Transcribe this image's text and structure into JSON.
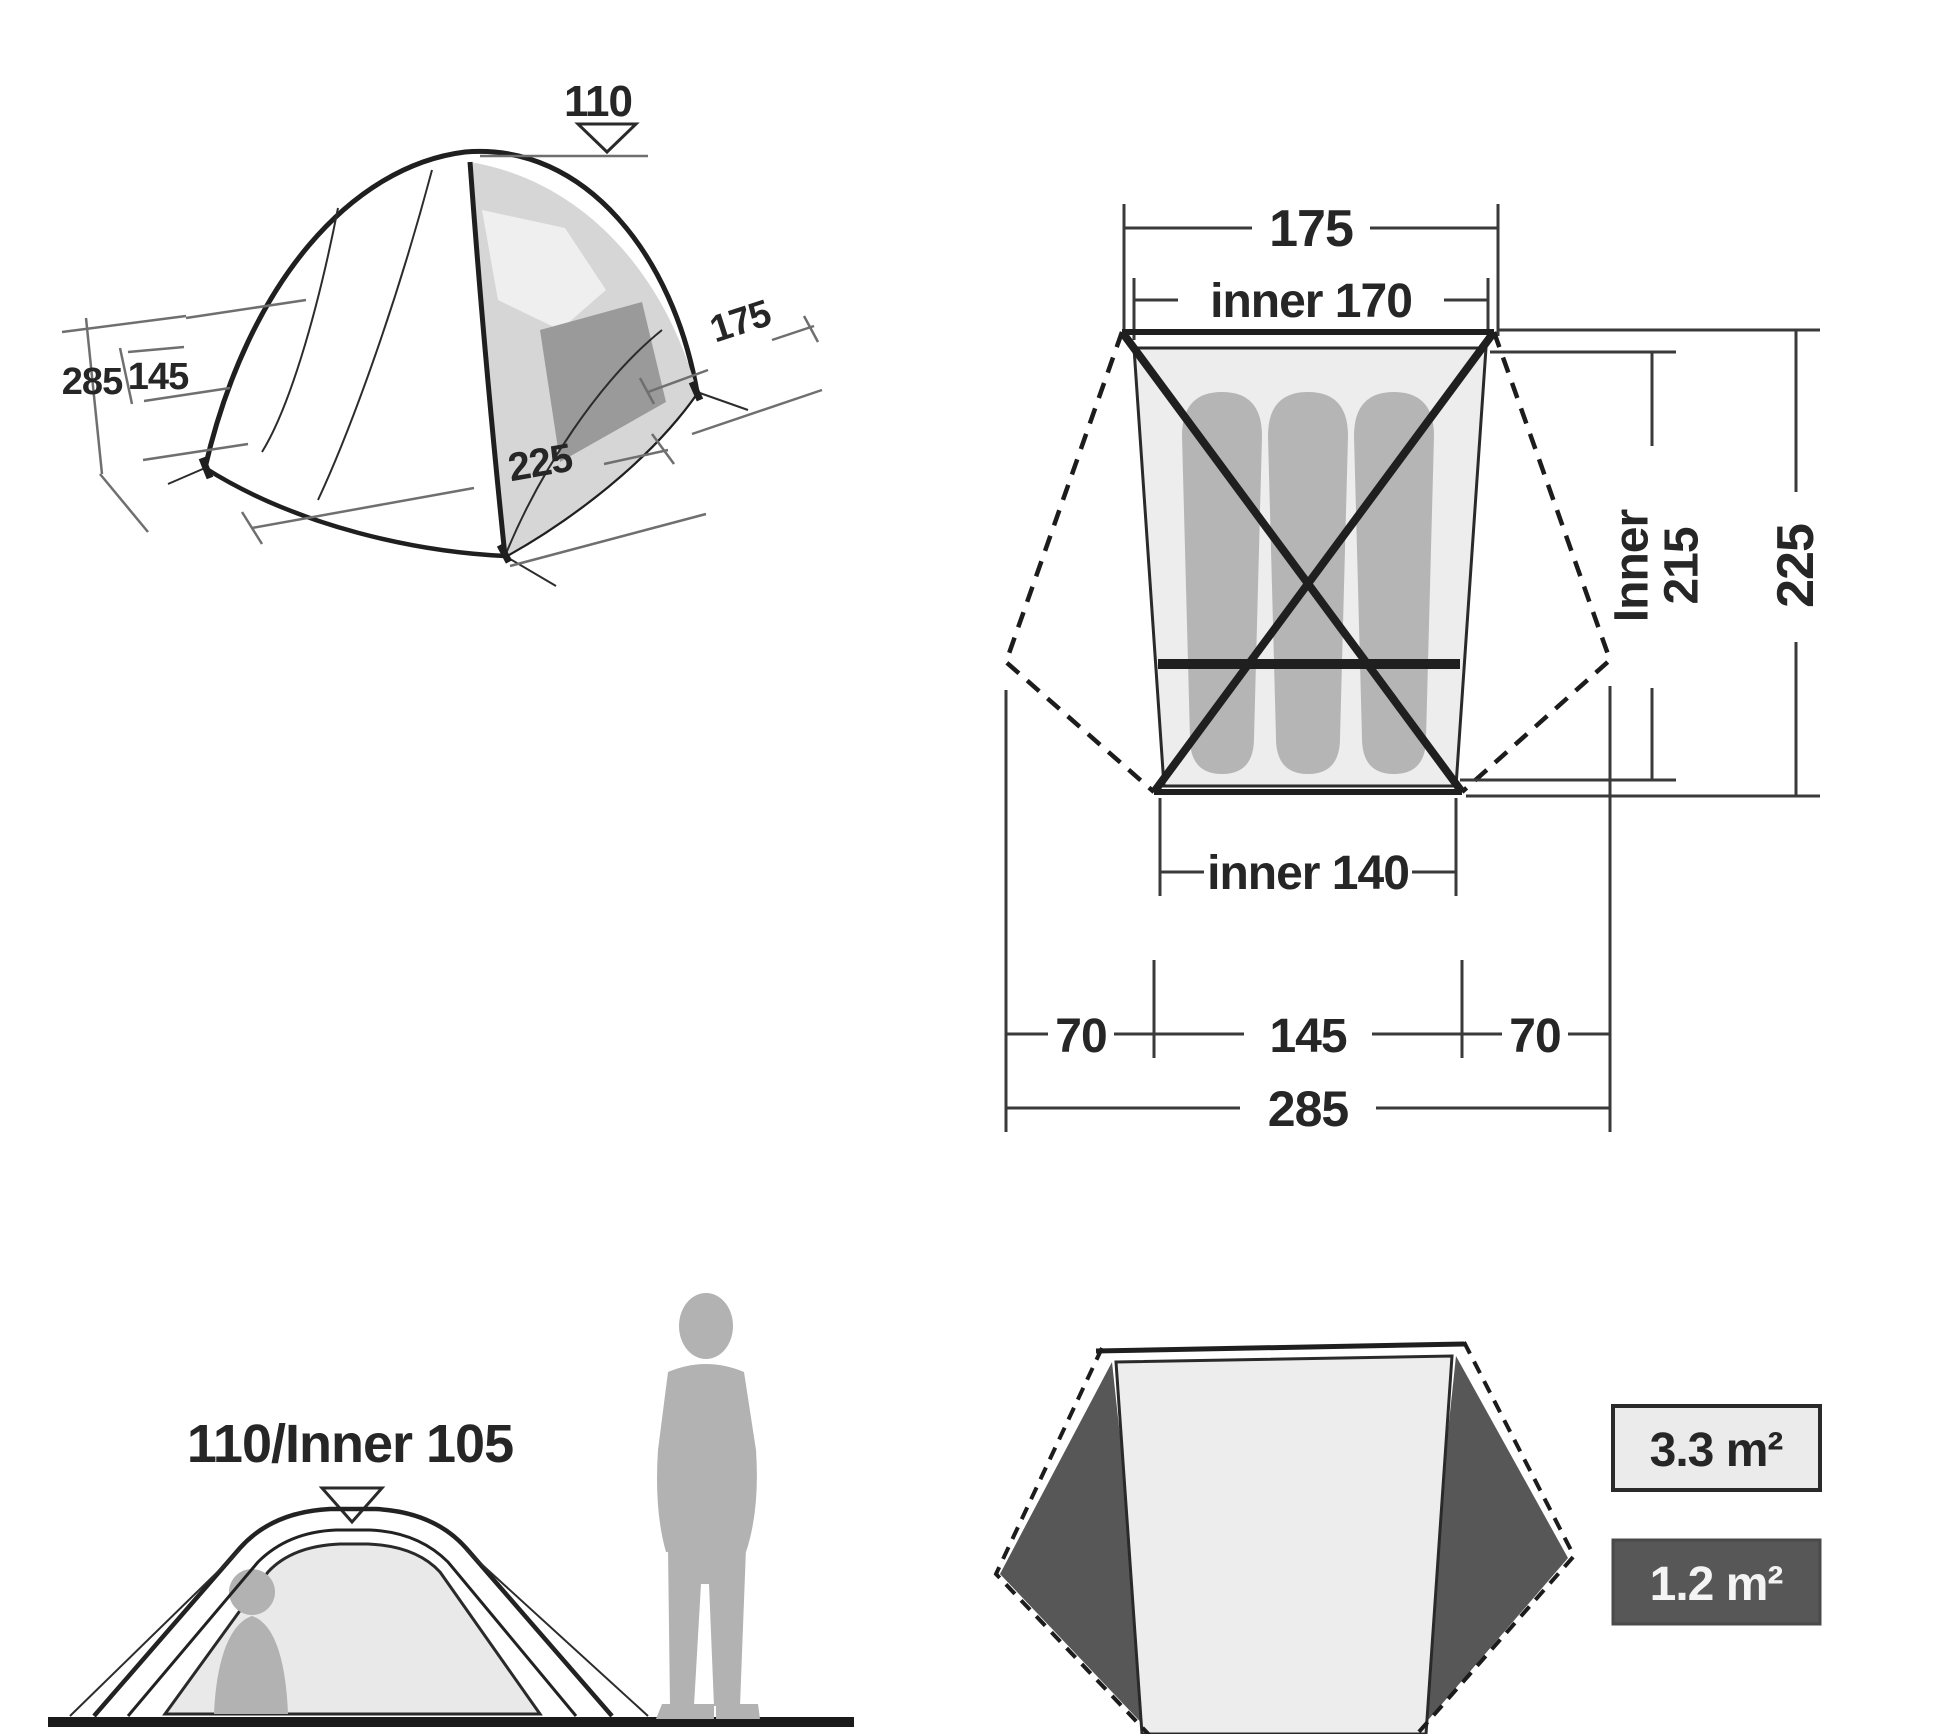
{
  "views": {
    "perspective": {
      "height": "110",
      "side": "175",
      "depth_total": "285",
      "depth_inner": "145",
      "length": "225"
    },
    "plan": {
      "width_top": "175",
      "width_top_inner": "inner 170",
      "length_inner_l1": "Inner",
      "length_inner_l2": "215",
      "length_outer": "225",
      "width_bottom_inner": "inner 140",
      "vestibule_left": "70",
      "width_floor": "145",
      "vestibule_right": "70",
      "width_total": "285"
    },
    "elevation": {
      "height": "110/Inner 105"
    },
    "floorplan": {
      "area_inner": "3.3 m²",
      "area_vestibule": "1.2 m²"
    }
  },
  "colors": {
    "line": "#1f1f1f",
    "dimension": "#6f6f6f",
    "mat": "#b5b5b5",
    "inner_floor": "#ededed",
    "vestibule": "#575757",
    "silhouette": "#b2b2b2",
    "legend_light": "#ebebeb",
    "legend_dark": "#575757"
  }
}
